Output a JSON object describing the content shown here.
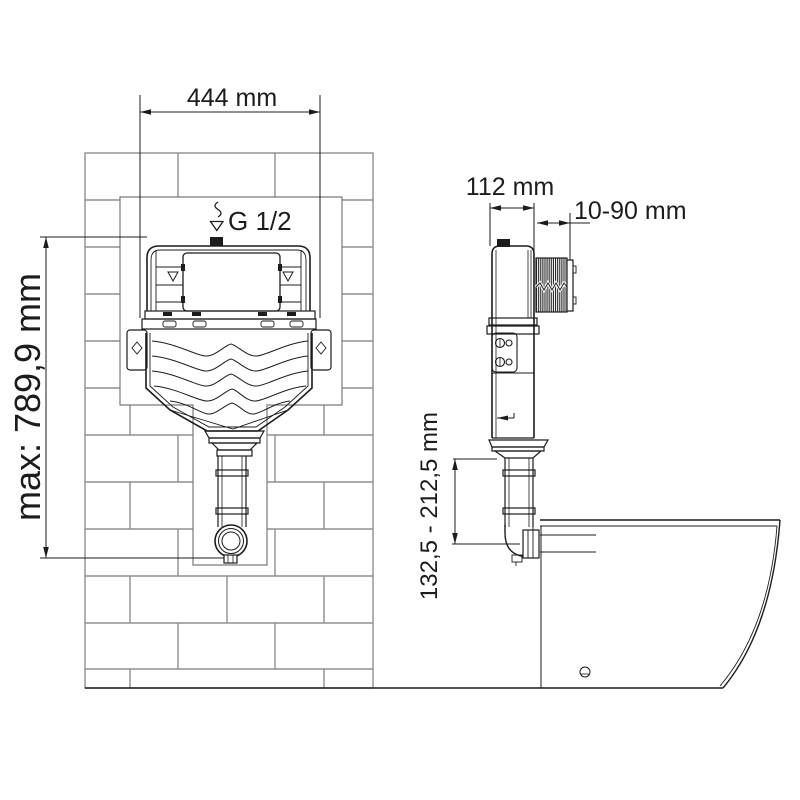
{
  "drawing": {
    "type": "installation-drawing",
    "subject": "concealed-cistern-with-toilet",
    "labels": {
      "front_width": "444 mm",
      "front_height": "max: 789,9 mm",
      "water_supply": "G 1/2",
      "side_depth": "112 mm",
      "wall_finish_range": "10-90 mm",
      "outlet_height_range": "132,5 - 212,5 mm"
    },
    "values": {
      "front_width_mm": 444,
      "max_height_mm": 789.9,
      "side_depth_mm": 112,
      "wall_finish_min_mm": 10,
      "wall_finish_max_mm": 90,
      "outlet_height_min_mm": 132.5,
      "outlet_height_max_mm": 212.5,
      "inlet_thread": "G 1/2"
    },
    "colors": {
      "line": "#1c1c1c",
      "brick_line": "#8f8f8f",
      "background": "#ffffff"
    }
  }
}
